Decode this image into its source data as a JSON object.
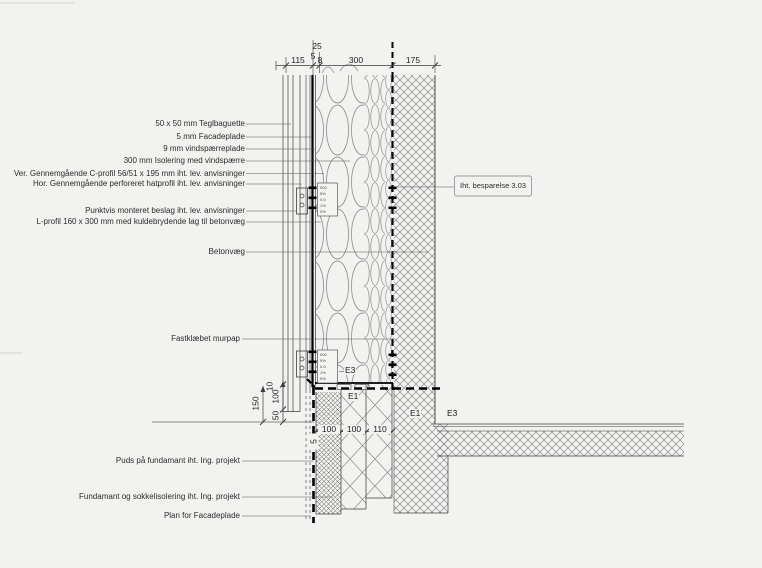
{
  "colors": {
    "background": "#f2f2f0",
    "line": "#3c3c3c",
    "thick_line": "#000000",
    "hatch": "#777777",
    "box_border": "#999999"
  },
  "callouts": {
    "teglbaguette": "50 x 50 mm Teglbaguette",
    "facadeplade": "5 mm Facadeplade",
    "vindspaerreplade": "9 mm vindspærreplade",
    "isolering": "300 mm Isolering med vindspærre",
    "c_profil": "Ver. Gennemgående C-profil 56/51 x 195 mm iht. lev. anvisninger",
    "hatprofil": "Hor. Gennemgående perforeret hatprofil iht. lev. anvisninger",
    "beslag": "Punktvis monteret beslag iht. lev. anvisninger",
    "l_profil": "L-profil 160 x 300 mm med kuldebrydende lag til betonvæg",
    "betonvaeg": "Betonvæg",
    "murpap": "Fastklæbet murpap",
    "puds": "Puds på fundamant iht. Ing. projekt",
    "fundamant": "Fundamant og sokkelisolering iht. Ing. projekt",
    "plan_facadeplade": "Plan for Facadeplade",
    "besparelse": "Iht. besparelse 3.03"
  },
  "dimensions": {
    "top": {
      "d115": "115",
      "d25": "25",
      "d5": "5",
      "d8": "8",
      "d300": "300",
      "d175": "175"
    },
    "bottom": {
      "b100a": "100",
      "b100b": "100",
      "b110": "110",
      "b5": "5"
    },
    "vertical": {
      "v150": "150",
      "v100": "100",
      "v50": "50",
      "v10": "10"
    }
  },
  "zone_labels": {
    "e3_upper": "E3",
    "e1_upper": "E1",
    "e1_lower": "E1",
    "e3_lower": "E3"
  },
  "detail_rows": [
    "000",
    "5%",
    "0-0",
    "1%",
    "0%"
  ]
}
